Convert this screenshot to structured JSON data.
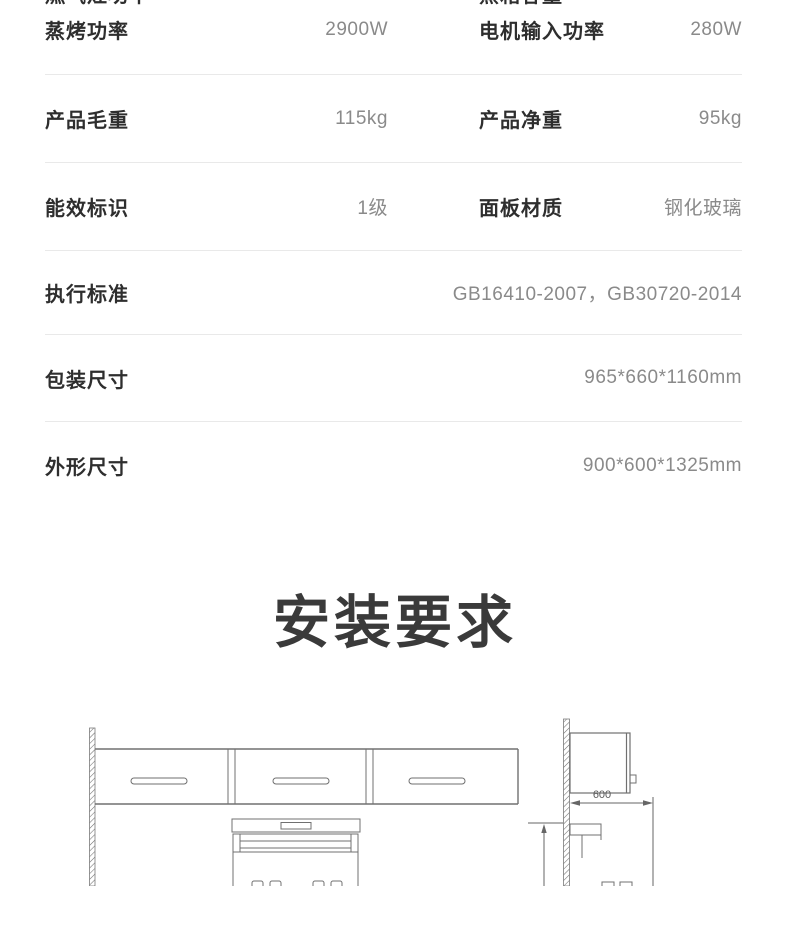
{
  "spec_table": {
    "rows": [
      {
        "left_label": "燃气灶功率",
        "left_value": "4.5kW",
        "right_label": "蒸箱容量",
        "right_value": "60L"
      },
      {
        "left_label": "蒸烤功率",
        "left_value": "2900W",
        "right_label": "电机输入功率",
        "right_value": "280W"
      },
      {
        "left_label": "产品毛重",
        "left_value": "115kg",
        "right_label": "产品净重",
        "right_value": "95kg"
      },
      {
        "left_label": "能效标识",
        "left_value": "1级",
        "right_label": "面板材质",
        "right_value": "钢化玻璃"
      },
      {
        "label": "执行标准",
        "value": "GB16410-2007，GB30720-2014"
      },
      {
        "label": "包装尺寸",
        "value": "965*660*1160mm"
      },
      {
        "label": "外形尺寸",
        "value": "900*600*1325mm"
      }
    ]
  },
  "installation": {
    "title": "安装要求"
  },
  "diagram": {
    "dimension_label": "600"
  },
  "colors": {
    "label_text": "#2e2e2e",
    "value_text": "#8a8a8a",
    "divider": "#e9e9e9",
    "title_text": "#3a3a3a",
    "drawing_line": "#757575"
  }
}
